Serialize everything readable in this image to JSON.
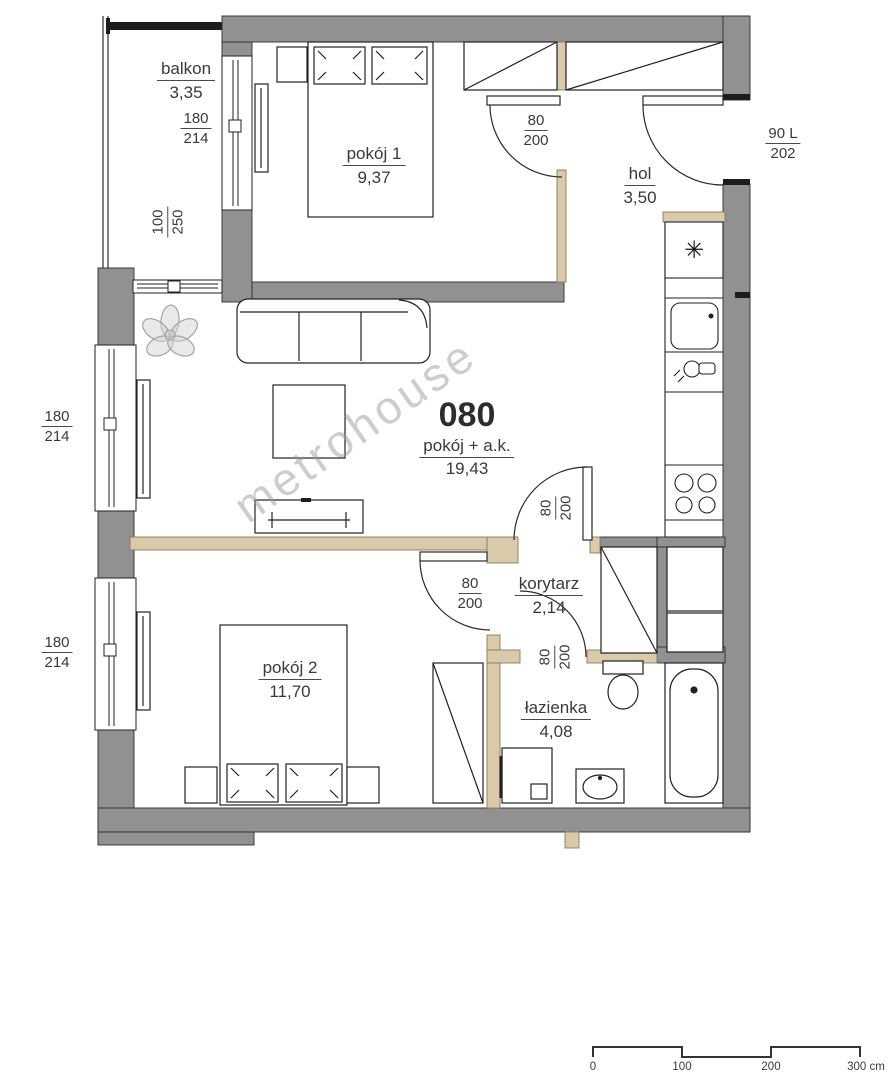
{
  "unit": {
    "number": "080"
  },
  "watermark": "metrohouse",
  "rooms": {
    "balkon": {
      "name": "balkon",
      "area": "3,35"
    },
    "pokoj1": {
      "name": "pokój 1",
      "area": "9,37"
    },
    "hol": {
      "name": "hol",
      "area": "3,50"
    },
    "salon": {
      "name": "pokój + a.k.",
      "area": "19,43"
    },
    "korytarz": {
      "name": "korytarz",
      "area": "2,14"
    },
    "pokoj2": {
      "name": "pokój 2",
      "area": "11,70"
    },
    "lazienka": {
      "name": "łazienka",
      "area": "4,08"
    }
  },
  "dims": {
    "balkon_window": {
      "w": "180",
      "h": "214"
    },
    "balkon_lr_window": {
      "w": "100",
      "h": "250"
    },
    "window1": {
      "w": "180",
      "h": "214"
    },
    "window2": {
      "w": "180",
      "h": "214"
    },
    "pokoj1_door": {
      "w": "80",
      "h": "200"
    },
    "entrance_door": {
      "w": "90 L",
      "h": "202"
    },
    "salon_door": {
      "w": "80",
      "h": "200"
    },
    "pokoj2_door": {
      "w": "80",
      "h": "200"
    },
    "lazienka_door": {
      "w": "80",
      "h": "200"
    }
  },
  "icons": {
    "fridge": "✳"
  },
  "scale_bar": {
    "ticks": [
      "0",
      "100",
      "200",
      "300 cm"
    ]
  },
  "colors": {
    "wall": "#919191",
    "partition": "#d9caa9",
    "line": "#222222",
    "watermark": "#969696"
  }
}
